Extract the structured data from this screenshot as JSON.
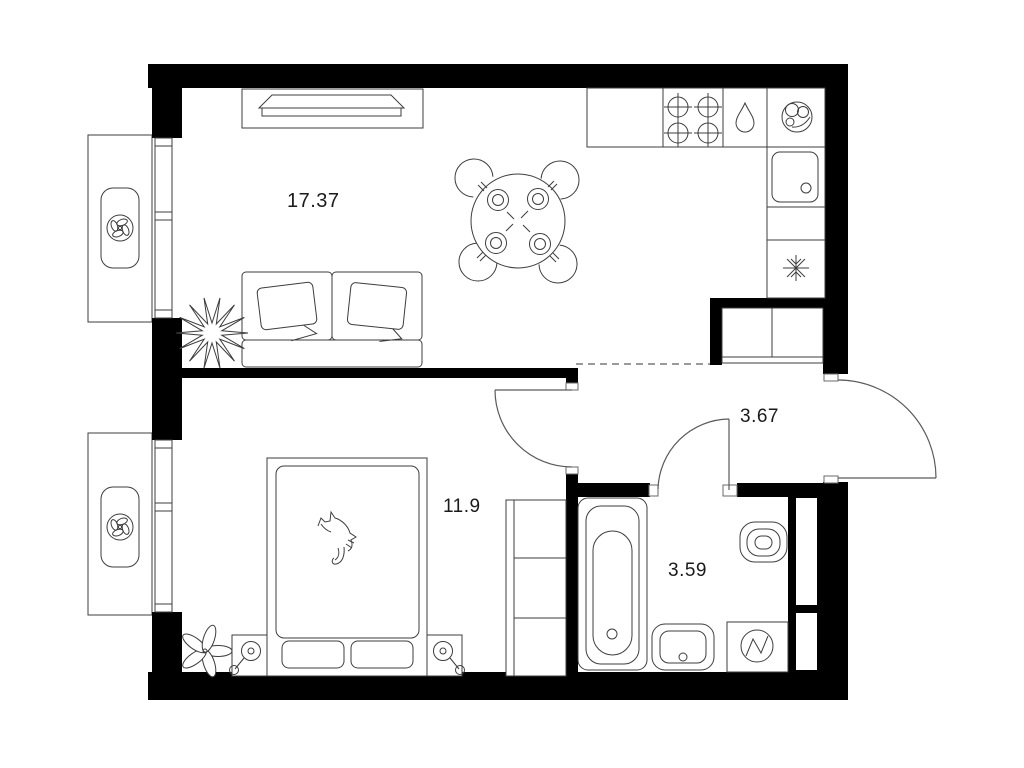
{
  "plan": {
    "type": "apartment-floor-plan",
    "background": "#ffffff",
    "wall_color": "#000000",
    "line_color": "#3d3d3d",
    "dashed_line_color": "#9a9a9a",
    "label_color": "#1b1b1b"
  },
  "rooms": [
    {
      "name": "living-room-kitchen",
      "area_label": "17.37"
    },
    {
      "name": "bedroom",
      "area_label": "11.9"
    },
    {
      "name": "hallway",
      "area_label": "3.67"
    },
    {
      "name": "bathroom",
      "area_label": "3.59"
    }
  ],
  "icons": [
    {
      "name": "fan-icon",
      "shape": "circle-with-four-petals"
    },
    {
      "name": "tv-icon",
      "shape": "trapezoid-panel"
    },
    {
      "name": "sofa-icon",
      "shape": "two-seat-sofa-with-pillows"
    },
    {
      "name": "plant-icon",
      "shape": "spiky-star"
    },
    {
      "name": "flower-icon",
      "shape": "five-petal-flower"
    },
    {
      "name": "dining-table-icon",
      "shape": "round-table-four-place-settings"
    },
    {
      "name": "chair-icon",
      "shape": "open-arc"
    },
    {
      "name": "stove-burner-icon",
      "shape": "circle-crosshair"
    },
    {
      "name": "water-drop-icon",
      "shape": "teardrop"
    },
    {
      "name": "round-sink-icon",
      "shape": "circle-with-small-circles"
    },
    {
      "name": "kitchen-sink-icon",
      "shape": "rounded-square-with-drain"
    },
    {
      "name": "snowflake-icon",
      "shape": "six-arm-snowflake"
    },
    {
      "name": "wardrobe-icon",
      "shape": "shelved-rectangle"
    },
    {
      "name": "bed-icon",
      "shape": "mattress-with-two-pillows"
    },
    {
      "name": "cat-icon",
      "shape": "cat-line-art"
    },
    {
      "name": "table-lamp-icon",
      "shape": "circle-with-stem"
    },
    {
      "name": "bathtub-icon",
      "shape": "rounded-rect-with-oval"
    },
    {
      "name": "toilet-icon",
      "shape": "nested-stadiums"
    },
    {
      "name": "washbasin-icon",
      "shape": "rounded-bowl-with-drain"
    },
    {
      "name": "washing-machine-icon",
      "shape": "square-with-circle-and-zigzag"
    },
    {
      "name": "door-swing-icon",
      "shape": "quarter-circle-arc"
    },
    {
      "name": "window-icon",
      "shape": "double-line-with-mullions"
    }
  ]
}
